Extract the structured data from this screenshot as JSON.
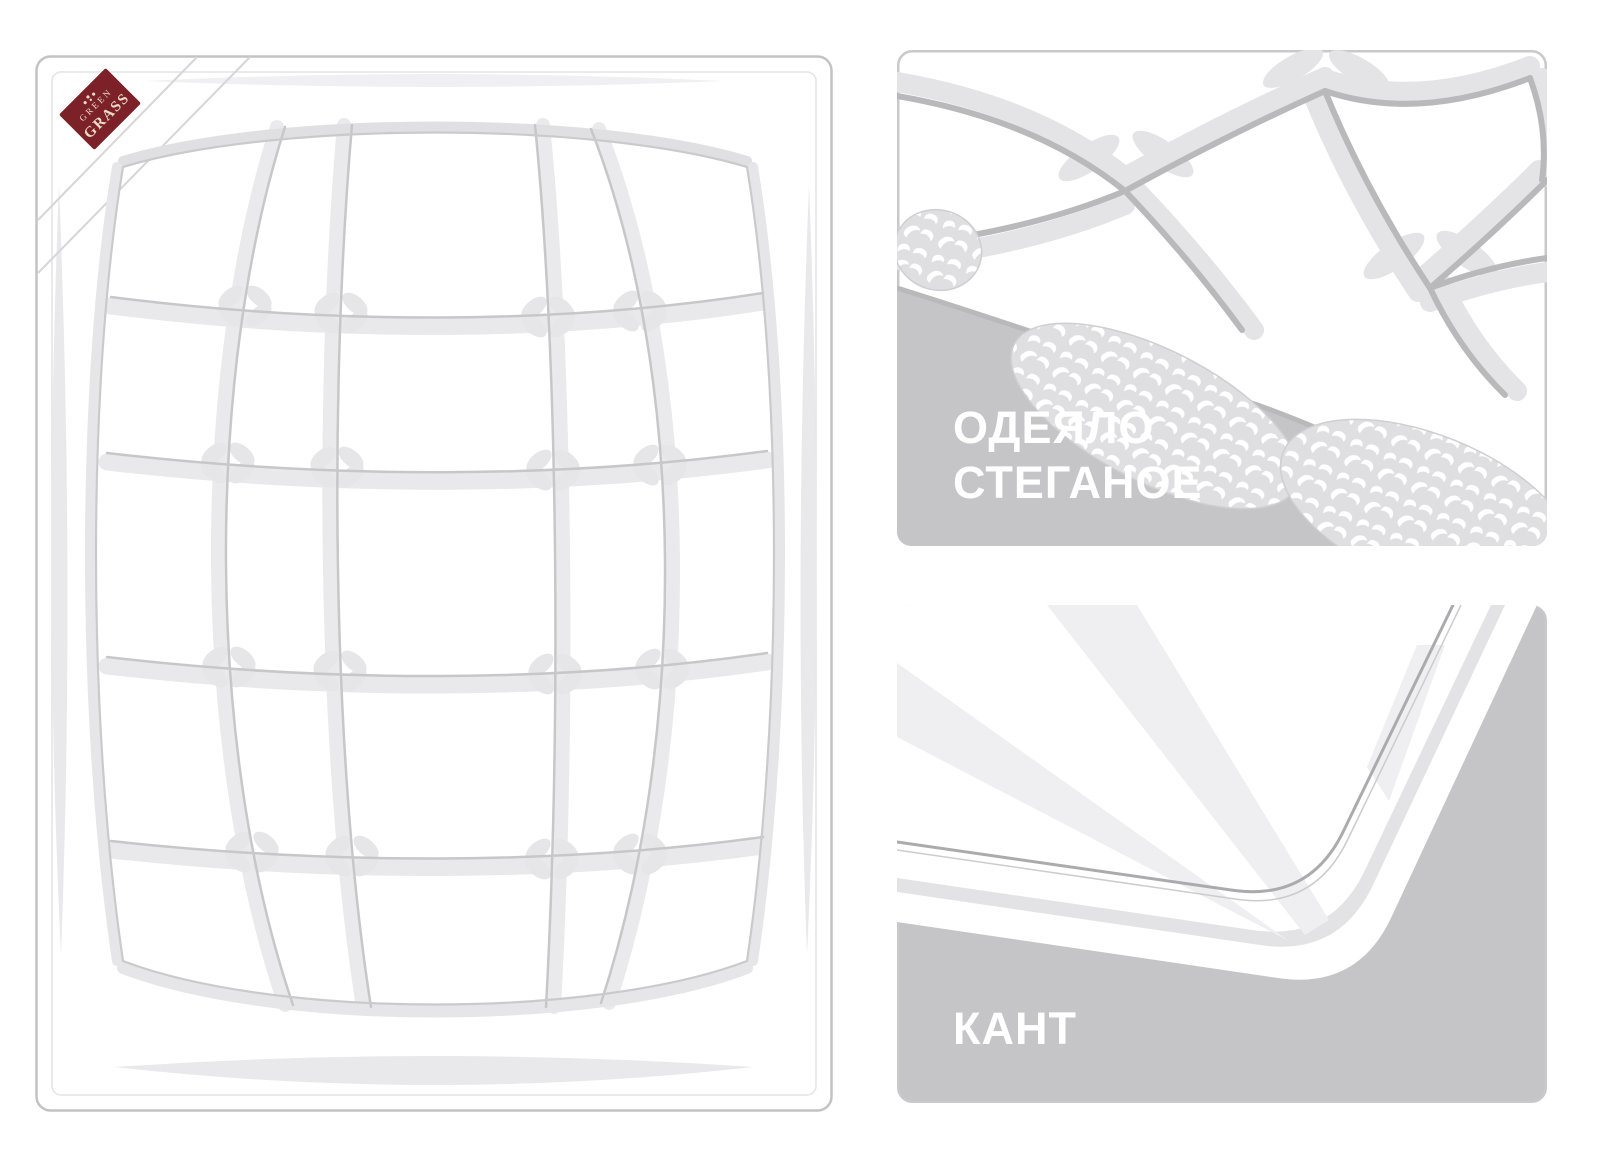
{
  "illustration": {
    "title_semantic": "quilted blanket product illustration",
    "brand_label": {
      "line1": "GREEN",
      "line2": "GRASS",
      "bg": "#7c2127",
      "fg": "#ecdcc6"
    },
    "panel_quilted": {
      "caption_line1": "ОДЕЯЛО",
      "caption_line2": "СТЕГАНОЕ"
    },
    "panel_edging": {
      "caption": "КАНТ"
    },
    "colors": {
      "panel_gray": "#c5c5c7",
      "seam_gray": "#b9b9bb",
      "quilt_seam_gray": "#c7c7c9",
      "shadow_light": "#e4e4e6",
      "border_gray": "#c9c9cb",
      "batting_bg": "#dfdfe1",
      "caption_white": "#ffffff"
    }
  }
}
